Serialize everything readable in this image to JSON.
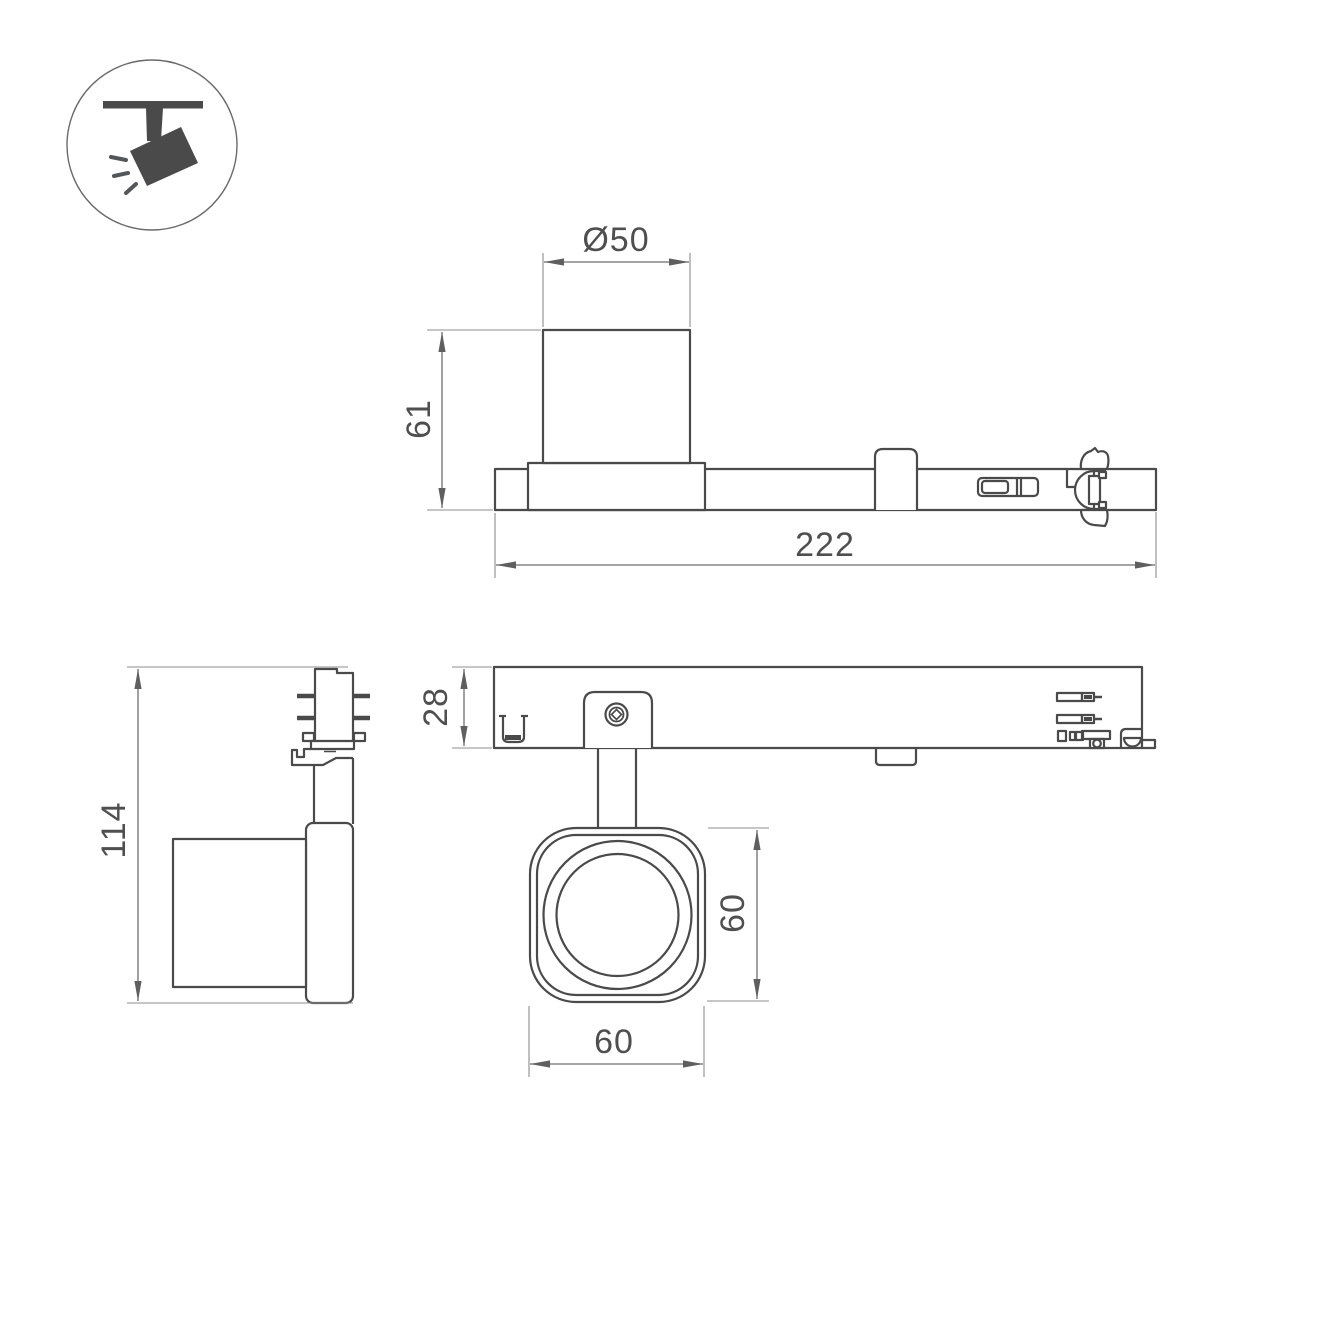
{
  "background": "#ffffff",
  "colors": {
    "object_line": "#4a4a4a",
    "dimension_line": "#6e6e6e",
    "extension_line": "#8d8d8d",
    "dimension_text": "#4f4f4f",
    "icon_fill": "#54575a"
  },
  "icon": {
    "name": "ceiling-track-spotlight",
    "description": "pictogram of a spotlight hanging from a ceiling track with light rays"
  },
  "dimensions": {
    "head_diameter": "Ø50",
    "head_height": "61",
    "track_adapter_length": "222",
    "overall_height": "114",
    "adapter_depth": "28",
    "head_size_vertical": "60",
    "head_size_horizontal": "60"
  }
}
